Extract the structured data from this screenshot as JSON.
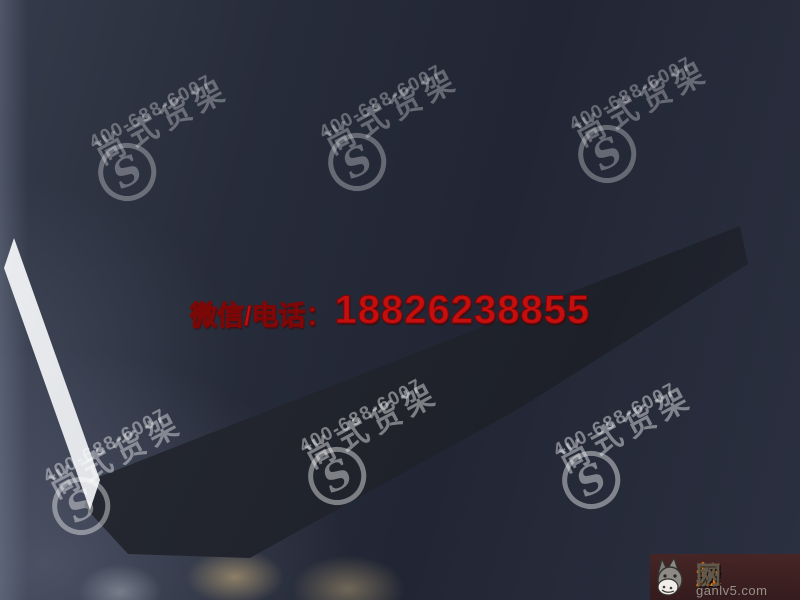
{
  "contact_banner": {
    "label": "微信/电话：",
    "phone": "18826238855",
    "color": "#c50e0e"
  },
  "watermark": {
    "brand": "尚式货架",
    "hotline": "400-688-6007",
    "monogram": "S",
    "angle_deg": -28,
    "placements": [
      {
        "x": 88,
        "y": 160,
        "opacity": 0.3
      },
      {
        "x": 318,
        "y": 150,
        "opacity": 0.3
      },
      {
        "x": 568,
        "y": 142,
        "opacity": 0.3
      },
      {
        "x": 42,
        "y": 494,
        "opacity": 0.4
      },
      {
        "x": 298,
        "y": 464,
        "opacity": 0.42
      },
      {
        "x": 552,
        "y": 468,
        "opacity": 0.42
      }
    ]
  },
  "corner_badge": {
    "site_chars": [
      "赶",
      "驴",
      "网"
    ],
    "char_colors": [
      "#e0760f",
      "#6b5c4a",
      "#60584d"
    ],
    "domain": "ganlv5.com"
  },
  "palette": {
    "background": "#262b38",
    "floor": "#8e8d85",
    "wood": "#c89c62",
    "wall_white": "#eceef1",
    "accent_green": "#2d6b35",
    "entrance_sign_red": "#cf1d1d",
    "slab_dark": "#23262f"
  },
  "scene": {
    "plan_size": [
      560,
      330
    ],
    "floor_quad": [
      [
        14,
        240
      ],
      [
        516,
        30
      ],
      [
        740,
        228
      ],
      [
        98,
        482
      ]
    ],
    "green_panels_nw": [
      126,
      252,
      380,
      466
    ],
    "green_panels_ne": [
      150
    ],
    "monitors_x": [
      8,
      26,
      44,
      62
    ],
    "lamps": [
      [
        24,
        18
      ],
      [
        46,
        15
      ],
      [
        68,
        13
      ]
    ],
    "glows": [
      [
        300,
        92
      ],
      [
        380,
        132
      ],
      [
        310,
        172
      ],
      [
        460,
        152
      ],
      [
        250,
        248
      ],
      [
        380,
        252
      ],
      [
        110,
        122
      ],
      [
        70,
        200
      ],
      [
        180,
        252
      ],
      [
        430,
        96
      ],
      [
        300,
        268
      ]
    ],
    "fixtures": [
      {
        "cls": "showcase",
        "x": 100,
        "y": 56,
        "w": 52,
        "h": 48
      },
      {
        "cls": "wood",
        "x": 42,
        "y": 96,
        "w": 54,
        "h": 46
      },
      {
        "cls": "slat",
        "x": 160,
        "y": 94,
        "w": 56,
        "h": 50
      },
      {
        "cls": "wood",
        "x": 172,
        "y": 28,
        "w": 58,
        "h": 50
      },
      {
        "cls": "wood-dark",
        "x": 34,
        "y": 158,
        "w": 48,
        "h": 50
      },
      {
        "cls": "wood",
        "x": 94,
        "y": 182,
        "w": 56,
        "h": 50
      },
      {
        "cls": "white-kiosk",
        "x": 224,
        "y": 116,
        "w": 26,
        "h": 28
      },
      {
        "cls": "wood",
        "x": 152,
        "y": 224,
        "w": 62,
        "h": 44
      },
      {
        "cls": "wood-light",
        "x": 240,
        "y": 236,
        "w": 46,
        "h": 42
      },
      {
        "cls": "wood-light",
        "x": 292,
        "y": 240,
        "w": 48,
        "h": 38
      },
      {
        "cls": "gondola",
        "x": 284,
        "y": 74,
        "w": 62,
        "h": 15
      },
      {
        "cls": "gondola",
        "x": 360,
        "y": 74,
        "w": 62,
        "h": 15
      },
      {
        "cls": "gondola",
        "x": 436,
        "y": 74,
        "w": 62,
        "h": 15
      },
      {
        "cls": "gondola",
        "x": 284,
        "y": 112,
        "w": 62,
        "h": 15
      },
      {
        "cls": "gondola",
        "x": 360,
        "y": 112,
        "w": 62,
        "h": 15
      },
      {
        "cls": "gondola",
        "x": 436,
        "y": 112,
        "w": 62,
        "h": 15
      },
      {
        "cls": "gondola",
        "x": 292,
        "y": 150,
        "w": 62,
        "h": 15
      },
      {
        "cls": "gondola",
        "x": 368,
        "y": 150,
        "w": 62,
        "h": 15
      },
      {
        "cls": "gondola",
        "x": 444,
        "y": 150,
        "w": 62,
        "h": 15
      },
      {
        "cls": "gondola",
        "x": 300,
        "y": 188,
        "w": 62,
        "h": 15
      },
      {
        "cls": "gondola",
        "x": 376,
        "y": 188,
        "w": 62,
        "h": 15
      },
      {
        "cls": "gondola",
        "x": 452,
        "y": 188,
        "w": 62,
        "h": 15
      },
      {
        "cls": "gondola",
        "x": 330,
        "y": 226,
        "w": 62,
        "h": 15
      },
      {
        "cls": "gondola",
        "x": 406,
        "y": 226,
        "w": 62,
        "h": 15
      },
      {
        "cls": "wood-light",
        "x": 350,
        "y": 262,
        "w": 88,
        "h": 22
      },
      {
        "cls": "shelf-east",
        "x": 500,
        "y": 60,
        "w": 28,
        "h": 58
      },
      {
        "cls": "shelf-east",
        "x": 500,
        "y": 144,
        "w": 28,
        "h": 58
      },
      {
        "cls": "shelf-east",
        "x": 500,
        "y": 224,
        "w": 28,
        "h": 50
      },
      {
        "cls": "plant",
        "x": 146,
        "y": 24,
        "w": 18,
        "h": 16
      },
      {
        "cls": "plant",
        "x": 190,
        "y": 32,
        "w": 14,
        "h": 13
      },
      {
        "cls": "plant",
        "x": 108,
        "y": 110,
        "w": 12,
        "h": 11
      }
    ]
  }
}
